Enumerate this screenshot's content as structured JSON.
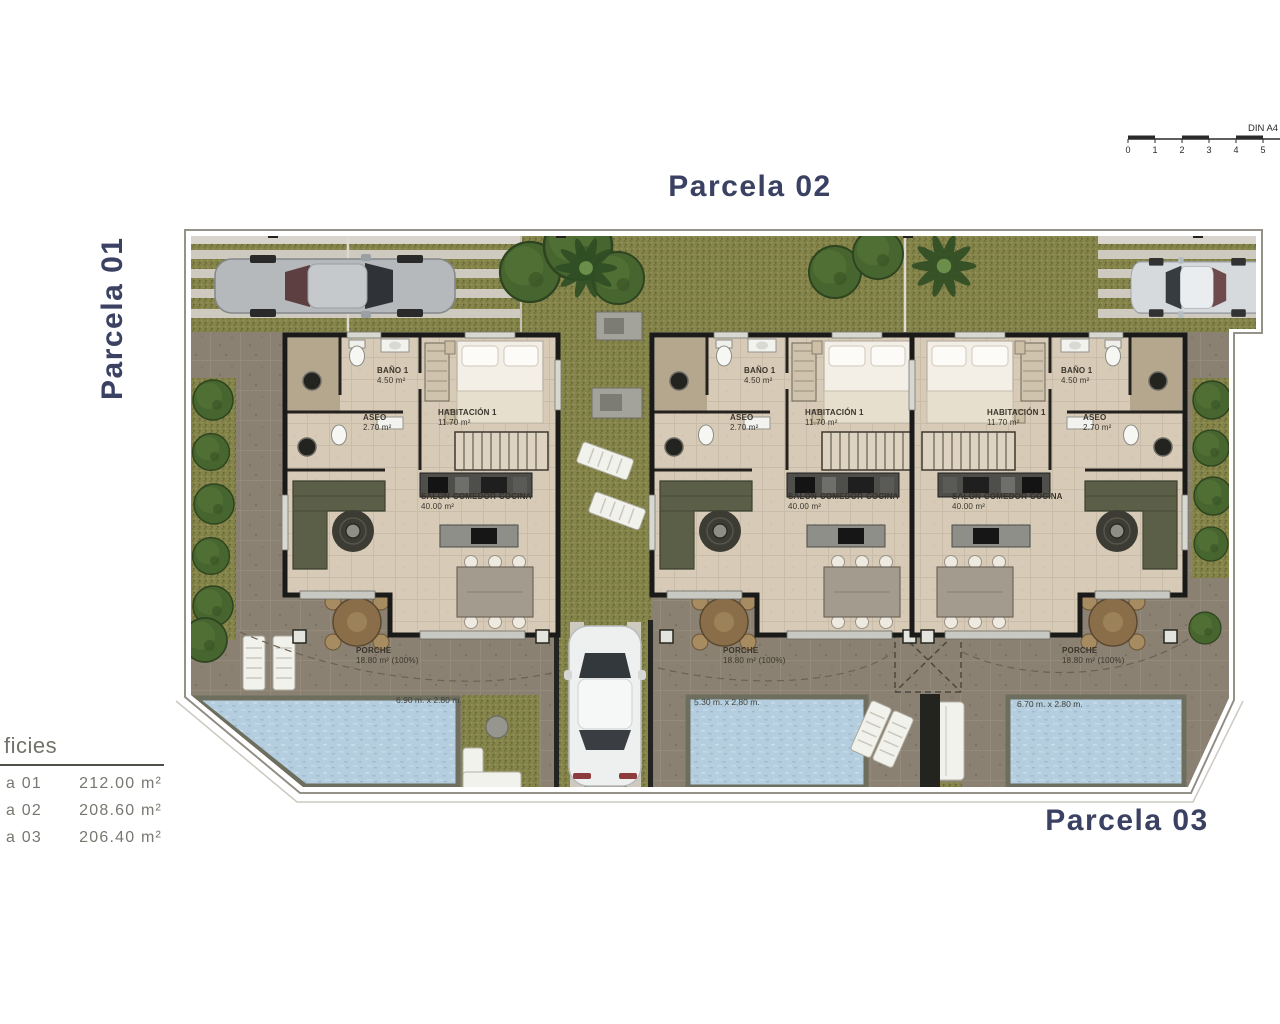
{
  "parcels": {
    "p1": "Parcela 01",
    "p2": "Parcela 02",
    "p3": "Parcela 03"
  },
  "scale_bar": {
    "label": "DIN A4",
    "ticks": [
      "0",
      "1",
      "2",
      "3",
      "4",
      "5"
    ]
  },
  "surface_table": {
    "heading": "ficies",
    "rows": [
      {
        "label": "a 01",
        "area": "212.00 m²"
      },
      {
        "label": "a 02",
        "area": "208.60 m²"
      },
      {
        "label": "a 03",
        "area": "206.40 m²"
      }
    ]
  },
  "villas": [
    {
      "name": "villa-1",
      "bano": "BAÑO 1",
      "bano_area": "4.50 m²",
      "aseo": "ASEO",
      "aseo_area": "2.70 m²",
      "habitacion": "HABITACIÓN 1",
      "habitacion_area": "11.70 m²",
      "salon": "SALÓN-COMEDOR-COCINA",
      "salon_area": "40.00 m²",
      "porche": "PORCHE",
      "porche_area": "18.80 m² (100%)",
      "pool_size": "6.90 m. x 2.80 m."
    },
    {
      "name": "villa-2",
      "bano": "BAÑO 1",
      "bano_area": "4.50 m²",
      "aseo": "ASEO",
      "aseo_area": "2.70 m²",
      "habitacion": "HABITACIÓN 1",
      "habitacion_area": "11.70 m²",
      "salon": "SALÓN-COMEDOR-COCINA",
      "salon_area": "40.00 m²",
      "porche": "PORCHE",
      "porche_area": "18.80 m² (100%)",
      "pool_size": "5.30 m. x 2.80 m."
    },
    {
      "name": "villa-3",
      "bano": "BAÑO 1",
      "bano_area": "4.50 m²",
      "aseo": "ASEO",
      "aseo_area": "2.70 m²",
      "habitacion": "HABITACIÓN 1",
      "habitacion_area": "11.70 m²",
      "salon": "SALÓN-COMEDOR-COCINA",
      "salon_area": "40.00 m²",
      "porche": "PORCHE",
      "porche_area": "18.80 m² (100%)",
      "pool_size": "6.70 m. x 2.80 m."
    }
  ],
  "colors": {
    "title_navy": "#3a4162",
    "grass": "#83834a",
    "terrace": "#8b8173",
    "pool": "#b4cedf",
    "floor": "#d7cbb8",
    "wall": "#1a1a18",
    "tree": "#47652f"
  }
}
